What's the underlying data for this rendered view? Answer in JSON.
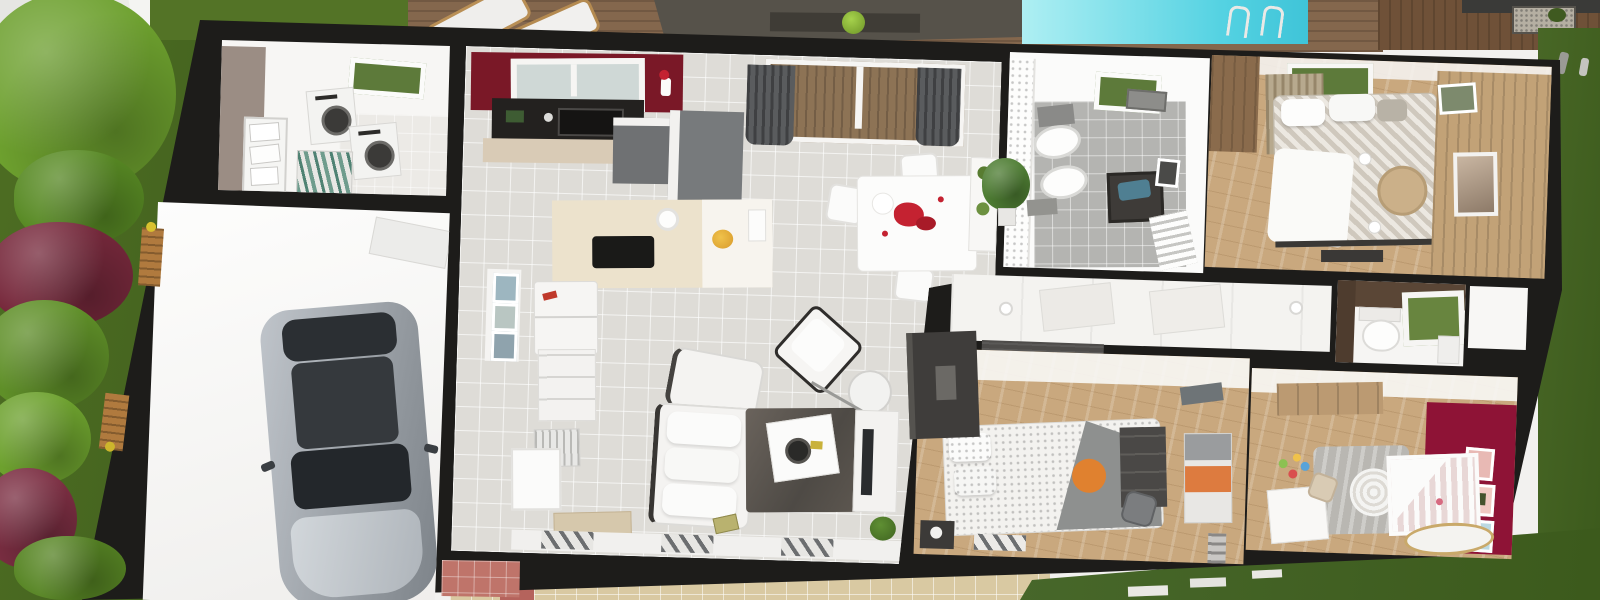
{
  "scene": {
    "description": "3D aerial cutaway rendering of a single-storey house floor plan with garden, wooden deck, shade sail, swimming pool and tiled patio",
    "palette": {
      "wall_black": "#1d1c1a",
      "grass_dark": "#42611f",
      "grass_light": "#537326",
      "tree_green": "#6da02e",
      "tree_burgundy": "#77293c",
      "deck_wood": "#84674d",
      "neighbour_wood": "#6f5138",
      "awning_gray": "#56524a",
      "pool_cyan": "#54d2e2",
      "floor_tile_gray": "#dedcd7",
      "bath_tile_gray": "#b4b4b1",
      "wood_floor_oak": "#c9a87e",
      "kitchen_accent_red": "#7a1827",
      "nursery_accent_red": "#8e1336",
      "laundry_taupe": "#9b8d84",
      "patio_tile_sand": "#d9c9a2",
      "entry_salmon": "#bf746a",
      "orange_accent": "#e0812f",
      "furniture_graphite": "#4a4846",
      "white": "#f7f6f4"
    },
    "outdoor": {
      "items": [
        {
          "id": "garden",
          "label": "Garden with trees and shrubs"
        },
        {
          "id": "lawn",
          "label": "Lawn"
        },
        {
          "id": "deck",
          "label": "Wooden terrace deck"
        },
        {
          "id": "awning",
          "label": "Shade sail over terrace"
        },
        {
          "id": "pool",
          "label": "Swimming pool with ladder"
        },
        {
          "id": "patio",
          "label": "Tiled patio"
        },
        {
          "id": "lounge-chairs",
          "label": "Deck lounge chairs"
        },
        {
          "id": "benches",
          "label": "Garden benches"
        },
        {
          "id": "gravel-bed",
          "label": "Gravel planting bed"
        },
        {
          "id": "neighbour-deck",
          "label": "Neighbouring wooden cabin deck"
        },
        {
          "id": "path-light",
          "label": "Garden path light"
        },
        {
          "id": "pavers",
          "label": "Stepping pavers"
        }
      ]
    },
    "rooms": [
      {
        "id": "laundry",
        "label": "Laundry room",
        "furniture": [
          "washer",
          "dryer",
          "wire shelving",
          "drying rack",
          "skylight"
        ]
      },
      {
        "id": "garage",
        "label": "Garage",
        "furniture": [
          "car",
          "ceiling vent"
        ]
      },
      {
        "id": "living-kitchen",
        "label": "Open-plan kitchen, dining and living room",
        "furniture": [
          "kitchen window",
          "sink counter",
          "tall cabinets",
          "island with cooktop",
          "fridge",
          "drawer unit",
          "dish rack",
          "sliding glass door",
          "curtains",
          "dining table with petals",
          "dining chairs",
          "plant",
          "console",
          "sofa",
          "armchairs",
          "rug",
          "coffee table",
          "arc floor lamp",
          "tv stand",
          "doormat",
          "wall frames"
        ]
      },
      {
        "id": "bathroom",
        "label": "Bathroom",
        "furniture": [
          "shower curtain",
          "double sinks",
          "towels",
          "skylight",
          "laundry basket",
          "towel radiator",
          "picture frame"
        ]
      },
      {
        "id": "master-bedroom",
        "label": "Master bedroom",
        "furniture": [
          "double bed",
          "pillows",
          "blinds",
          "window",
          "plank accent wall",
          "picture frames",
          "round stool",
          "bench"
        ]
      },
      {
        "id": "hallway",
        "label": "Hallway",
        "furniture": [
          "recessed downlights"
        ]
      },
      {
        "id": "wardrobe",
        "label": "Sliding-door wardrobe",
        "furniture": []
      },
      {
        "id": "wc",
        "label": "WC",
        "furniture": [
          "toilet",
          "window",
          "cabinet"
        ]
      },
      {
        "id": "bedroom2",
        "label": "Bedroom 2",
        "furniture": [
          "bed with orange cushion",
          "gray throw",
          "slippers",
          "nightstand",
          "desk unit",
          "chair",
          "wardrobe with orange band",
          "photo shelf",
          "wall shelf"
        ]
      },
      {
        "id": "nursery",
        "label": "Nursery",
        "furniture": [
          "crib",
          "round rug",
          "pendant lamp",
          "desk",
          "toys",
          "bassinet",
          "accent wall frames",
          "wardrobe top"
        ]
      },
      {
        "id": "entry",
        "label": "Entry porch",
        "furniture": []
      },
      {
        "id": "storage",
        "label": "Storage recess",
        "furniture": []
      }
    ]
  }
}
